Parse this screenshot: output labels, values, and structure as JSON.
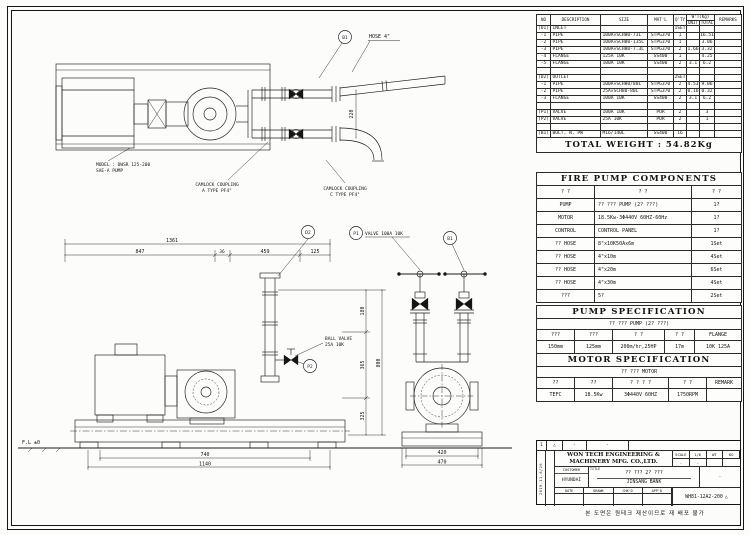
{
  "parts_table": {
    "headers": {
      "no": "NO",
      "description": "DESCRIPTION",
      "size": "SIZE",
      "matl": "MAT'L",
      "qty": "Q'TY",
      "wt": "W'T(Kg)",
      "unit": "UNIT",
      "total": "TOTAL",
      "remarks": "REMARKS"
    },
    "rows": [
      [
        "(D1)",
        "INLET",
        "",
        "",
        "1SET",
        "",
        "",
        ""
      ],
      [
        "-1",
        "PIPE",
        "100A×SCH80-73L",
        "STPG370",
        "1",
        "",
        "16.51",
        ""
      ],
      [
        "-2",
        "PIPE",
        "100A×SCH80-135L",
        "STPG370",
        "1",
        "",
        "3.06",
        ""
      ],
      [
        "-3",
        "PIPE",
        "100A×SCH80-7.3L",
        "STPG370",
        "2",
        "1.66",
        "3.32",
        ""
      ],
      [
        "-4",
        "FLANGE",
        "125A 10K",
        "SS400",
        "1",
        "",
        "4.25",
        ""
      ],
      [
        "-5",
        "FLANGE",
        "100A 10K",
        "SS400",
        "2",
        "3.1",
        "6.2",
        ""
      ],
      [
        "",
        "",
        "",
        "",
        "",
        "",
        "",
        ""
      ],
      [
        "(D2)",
        "OUTLET",
        "",
        "",
        "2SET",
        "",
        "",
        ""
      ],
      [
        "-1",
        "PIPE",
        "100A×SCH80/80L",
        "STPG370",
        "2",
        "4.53",
        "9.06",
        ""
      ],
      [
        "-2",
        "PIPE",
        "25A×SCH80-80L",
        "STPG370",
        "2",
        "0.16",
        "0.32",
        ""
      ],
      [
        "-3",
        "FLANGE",
        "100A 10K",
        "SS400",
        "2",
        "3.1",
        "6.2",
        ""
      ],
      [
        "",
        "",
        "",
        "",
        "",
        "",
        "",
        ""
      ],
      [
        "(P1)",
        "VALVE",
        "100A 10K",
        "PUR",
        "2",
        "",
        "3",
        ""
      ],
      [
        "(P2)",
        "VALVE",
        "25A 10K",
        "PUR",
        "2",
        "",
        "1",
        ""
      ],
      [
        "",
        "",
        "",
        "",
        "",
        "",
        "",
        ""
      ],
      [
        "(B1)",
        "BOLT, N, PW",
        "M16/140L",
        "SS400",
        "16",
        "",
        "",
        ""
      ]
    ],
    "total_weight": "TOTAL WEIGHT : 54.82Kg"
  },
  "components": {
    "title": "FIRE PUMP COMPONENTS",
    "headers": [
      "? ?",
      "? ?",
      "? ?"
    ],
    "rows": [
      [
        "PUMP",
        "?? ??? PUMP (2? ???)",
        "1?"
      ],
      [
        "MOTOR",
        "18.5Kw-3Φ440V 60HZ-60Hz",
        "1?"
      ],
      [
        "CONTROL",
        "CONTROL PANEL",
        "1?"
      ],
      [
        "?? HOSE",
        "8\"x10K50Ax6m",
        "1Set"
      ],
      [
        "?? HOSE",
        "4\"x10m",
        "4Set"
      ],
      [
        "?? HOSE",
        "4\"x20m",
        "6Set"
      ],
      [
        "?? HOSE",
        "4\"x30m",
        "4Set"
      ],
      [
        "???",
        "5?",
        "2Set"
      ]
    ]
  },
  "pump_spec": {
    "title": "PUMP SPECIFICATION",
    "subtitle": "?? ??? PUMP (2? ???)",
    "headers": [
      "???",
      "???",
      "? ?",
      "? ?",
      "FLANGE"
    ],
    "values": [
      "150mm",
      "125mm",
      "200m/hr,25HP",
      "17m",
      "10K 125A"
    ]
  },
  "motor_spec": {
    "title": "MOTOR SPECIFICATION",
    "subtitle": "?? ??? MOTOR",
    "headers": [
      "??",
      "??",
      "? ? ? ?",
      "? ?",
      "REMARK"
    ],
    "values": [
      "TEFC",
      "18.5Kw",
      "3Φ440V 60HZ",
      "1750RPM",
      ""
    ]
  },
  "title_block": {
    "rev_no": "1",
    "rev_mark": "△",
    "rev_dash1": "-",
    "rev_dash2": "-",
    "company_line1": "WON TECH ENGINEERING &",
    "company_line2": "MACHINERY MFG. CO.,LTD.",
    "customer_label": "CUSTOMER",
    "customer": "HYUNDAI",
    "title_label": "TITLE",
    "title_line1": "?? ??? 2? ???",
    "title_line2": "JINSANG BANK",
    "scale_label": "SCALE",
    "scale": "1/6",
    "wt_label": "WT",
    "wt": "KG",
    "blank1": "-",
    "blank2": "-",
    "side_dash": "-",
    "date_text": "2019-11-8/26",
    "approvals": [
      "DATE",
      "DRAWN",
      "CHK'D",
      "APP'D"
    ],
    "dwg_no": "WH81-12A2-200",
    "dwg_mark": "△",
    "note": "본 도면은 원테크 재산이므로 재 배포 불가"
  },
  "drawing": {
    "balloon_b1": "B1",
    "balloon_b1b": "B1",
    "balloon_d2": "D2",
    "balloon_p1": "P1",
    "balloon_p2": "P2",
    "hose_label": "HOSE 4\"",
    "model_line1": "MODEL : DWSR 125-200",
    "model_line2": "SAE-A PUMP",
    "camlock_a1": "CAMLOCK COUPLING",
    "camlock_a2": "A TYPE PF4\"",
    "camlock_c1": "CAMLOCK COUPLING",
    "camlock_c2": "C TYPE PF4\"",
    "valve_p1_label": "VALVE 100A 10K",
    "ball_valve_1": "BALL VALVE",
    "ball_valve_2": "25A 10K",
    "fl_label": "F.L ±0",
    "dims": {
      "overall": "1361",
      "seg1": "847",
      "seg2": "36",
      "seg3": "459",
      "seg4": "125",
      "base_inner": "740",
      "base_outer": "1140",
      "det_inner": "420",
      "det_outer": "470",
      "plan_h": "220",
      "v1": "180",
      "v2": "365",
      "v3": "325",
      "v_overall": "800"
    }
  }
}
